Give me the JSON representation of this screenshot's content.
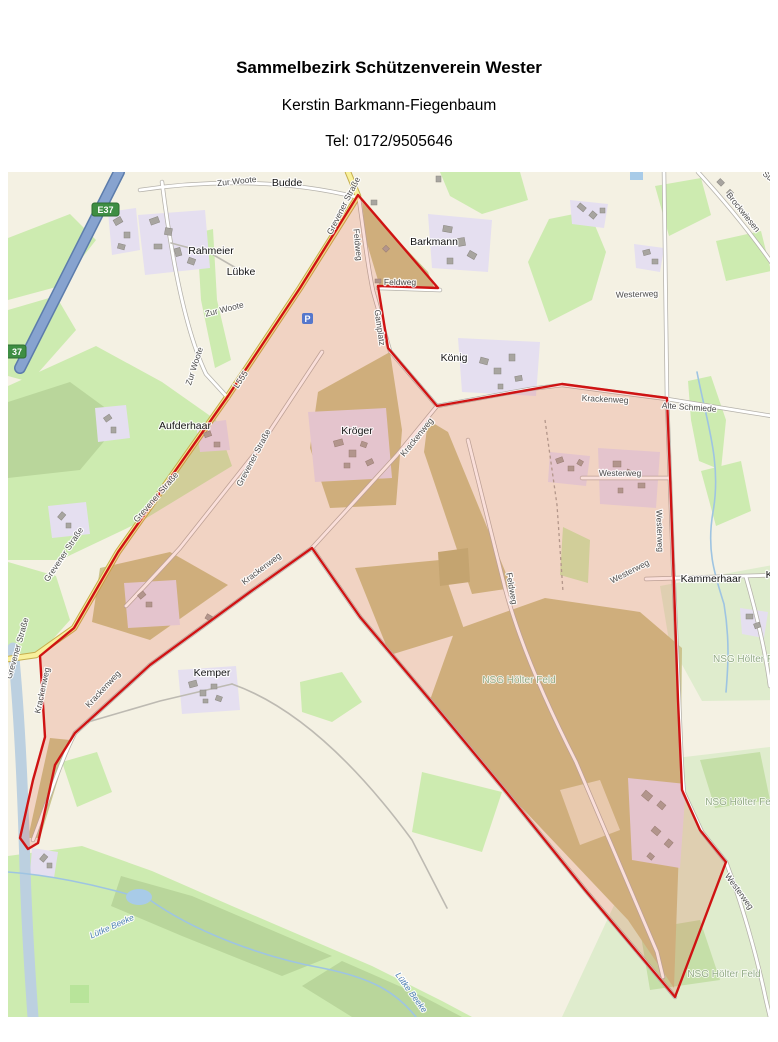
{
  "header": {
    "title": "Sammelbezirk Schützenverein Wester",
    "contact_name": "Kerstin Barkmann-Fiegenbaum",
    "phone": "Tel: 0172/9505646"
  },
  "map": {
    "badges": {
      "motorway": "E37",
      "motorway_partial": "37",
      "parking": "P"
    },
    "road_labels": {
      "zur_woote_1": "Zur Woote",
      "zur_woote_2": "Zur Woote",
      "zur_woote_3": "Zur Woote",
      "l555": "L555",
      "grevener_1": "Grevener Straße",
      "grevener_2": "Grevener Straße",
      "grevener_3": "Grevener Straße",
      "grevener_4": "Grevener Straße",
      "grevener_5": "Grevener Straße",
      "feldweg_1": "Feldweg",
      "feldweg_2": "Feldweg",
      "feldweg_3": "Feldweg",
      "gamplatz": "Gamplatz",
      "krackenweg_1": "Krackenweg",
      "krackenweg_2": "Krackenweg",
      "krackenweg_3": "Krackenweg",
      "krackenweg_4": "Krackenweg",
      "krackenweg_5": "Krackenweg",
      "westerweg_1": "Westerweg",
      "westerweg_2": "Westerweg",
      "westerweg_3": "Westerweg",
      "westerweg_4": "Westerweg",
      "westerweg_5": "Westerweg",
      "alte_schmiede": "Alte Schmiede",
      "brockwiesen": "Brockwiesen",
      "su_partial": "Su"
    },
    "place_labels": {
      "budde": "Budde",
      "rahmeier": "Rahmeier",
      "luebke": "Lübke",
      "barkmann": "Barkmann",
      "koenig": "König",
      "kroeger": "Kröger",
      "aufderhaar": "Aufderhaar",
      "kemper": "Kemper",
      "kammerhaar": "Kammerhaar",
      "ka_partial": "Ka"
    },
    "area_labels": {
      "nsg_1": "NSG Hölter Feld",
      "nsg_2": "NSG Hölter F",
      "nsg_3": "NSG Hölter Fe",
      "nsg_4": "NSG Hölter Feld"
    },
    "water_labels": {
      "luetke_beeke_1": "Lütke Beeke",
      "luetke_beeke_2": "Lütke Beeke"
    },
    "colors": {
      "boundary_red": "#cf1313",
      "district_fill": "rgba(230,80,50,0.18)",
      "motorway_blue": "#87a3cf",
      "primary_yellow": "#f8f09c",
      "water_blue": "#bcd0e0",
      "grass_green": "#cdebb0",
      "farmland_olive": "#cbc48d",
      "nsg_mint": "#dfeccd",
      "badge_green": "#3e8e43"
    }
  }
}
